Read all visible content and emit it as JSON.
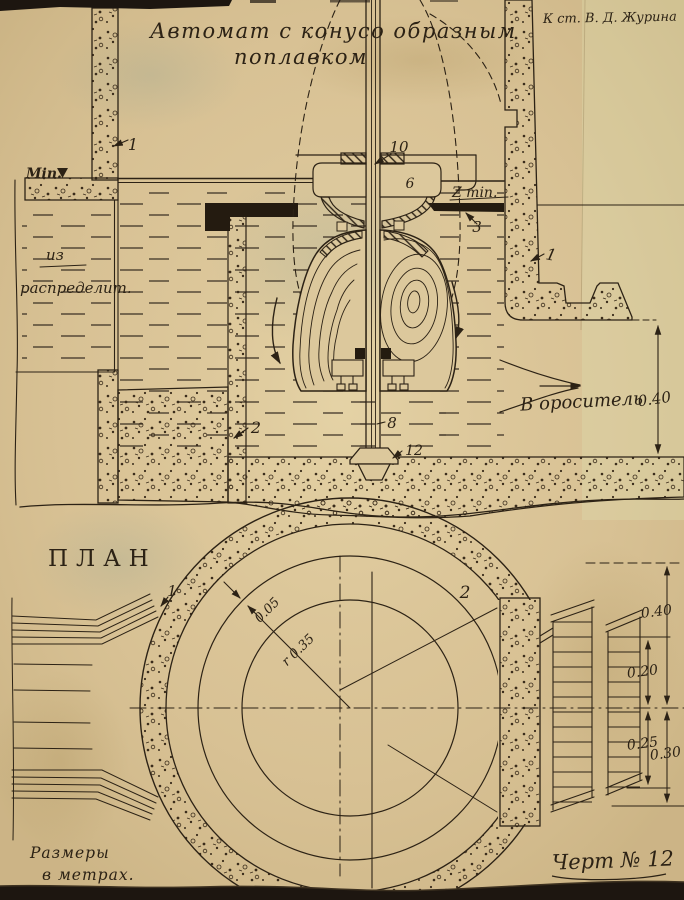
{
  "page": {
    "title_line1": "Автомат с конусо образным",
    "title_line2": "поплавком",
    "credit": "К ст. В. Д. Журина",
    "note_line1": "Размеры",
    "note_line2": "в метрах.",
    "drawing_no": "Черт № 12"
  },
  "section": {
    "min_label": "Min.",
    "inlet_line1": "из",
    "inlet_line2": "распределит.",
    "zmin_label": "Z min.",
    "outlet_label": "В ороситель",
    "dim_outlet_height": "0.40",
    "callouts": {
      "left_wall": "1",
      "right_wall": "1",
      "sump_wall": "2",
      "seat": "3",
      "valve_body": "6",
      "valve_flange": "10",
      "rod": "8",
      "anchor": "12"
    }
  },
  "plan": {
    "label": "ПЛАН",
    "callout_wall": "1",
    "callout_chamber": "2",
    "dim_wall_gap": "0.05",
    "dim_radius": "r 0.35",
    "dim_chain": [
      "0.40",
      "0.20",
      "0.25",
      "0.30"
    ]
  },
  "colors": {
    "paper": "#d8c193",
    "ink": "#2c2215"
  }
}
